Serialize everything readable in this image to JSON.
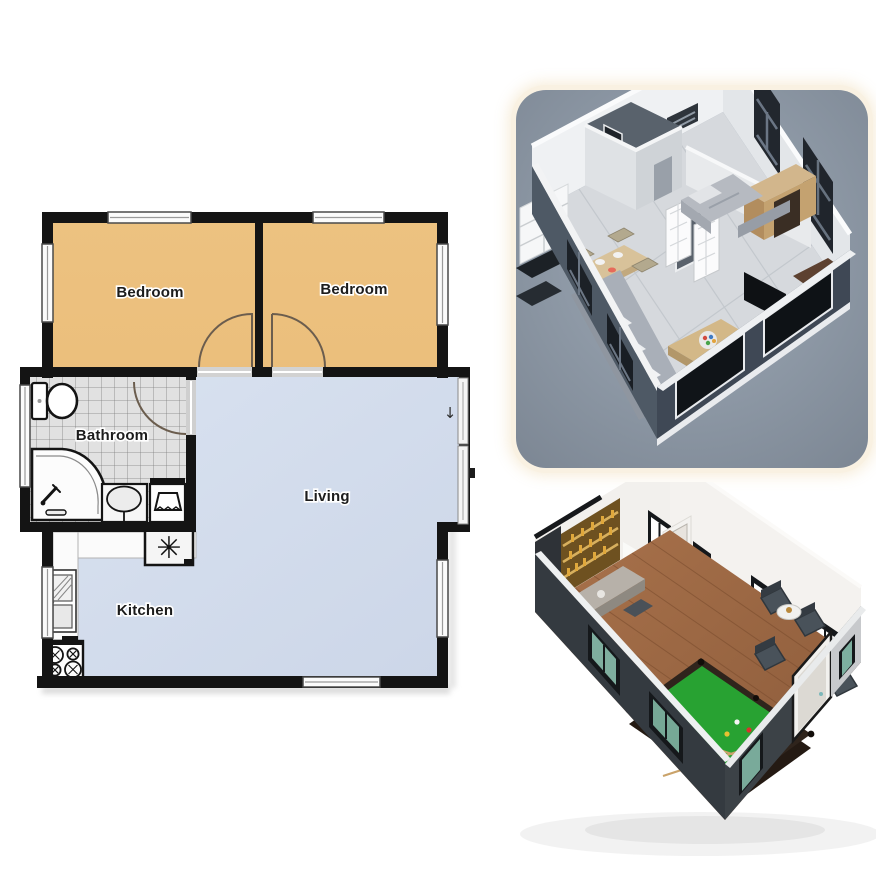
{
  "floor_plan": {
    "rooms": [
      {
        "label": "Bedroom",
        "fill": "#ecc07e"
      },
      {
        "label": "Bedroom",
        "fill": "#ecc07e"
      },
      {
        "label": "Bathroom",
        "fill": "#e1e1e1"
      },
      {
        "label": "Living",
        "fill": "#d3ddec"
      },
      {
        "label": "Kitchen",
        "fill": "#d3ddec"
      }
    ],
    "symbols": {
      "heater": "✳",
      "entry_arrow": "↓"
    },
    "wall_color": "#141414",
    "tile_line_color": "#7e7e7e",
    "window_fill": "#fbfbfb",
    "door_arc_color": "#6b5d4e"
  },
  "renders": {
    "top": {
      "background_top": "#9aa5b2",
      "background_bottom": "#7a8491",
      "frame_color": "#f9f1e2"
    },
    "bottom": {
      "pool_table_color": "#28a232",
      "pool_rim_color": "#2f241c",
      "wood_floor_color": "#a06a44",
      "wall_dark": "#373d43",
      "bar_color": "#6e5120"
    }
  }
}
